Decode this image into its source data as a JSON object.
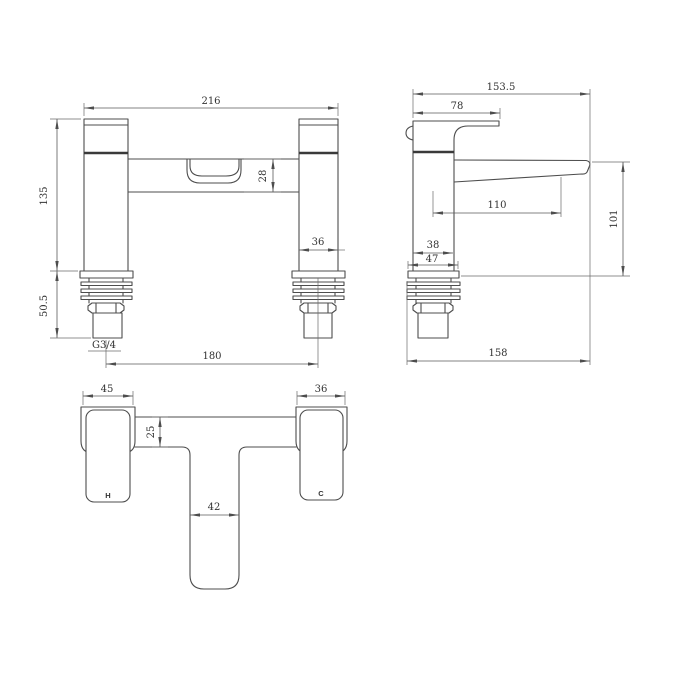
{
  "drawing": {
    "type": "technical-dimension-drawing",
    "subject": "bath-filler-mixer-tap",
    "line_color": "#4d4d4d",
    "thick_line_color": "#3a3a3a",
    "background_color": "#ffffff",
    "front_view": {
      "overall_width": "216",
      "body_height": "135",
      "crossbar_height": "28",
      "pillar_width": "36",
      "under_deck_height": "50.5",
      "thread_label": "G3/4",
      "inlet_centres": "180"
    },
    "side_view": {
      "overall_depth": "153.5",
      "handle_length": "78",
      "spout_reach": "110",
      "spout_height": "101",
      "body_depth": "38",
      "base_depth": "47",
      "total_depth": "158"
    },
    "plan_view": {
      "hot_handle_width": "45",
      "cold_handle_width": "36",
      "bar_depth": "25",
      "spout_width": "42",
      "hot_label": "H",
      "cold_label": "C"
    }
  }
}
